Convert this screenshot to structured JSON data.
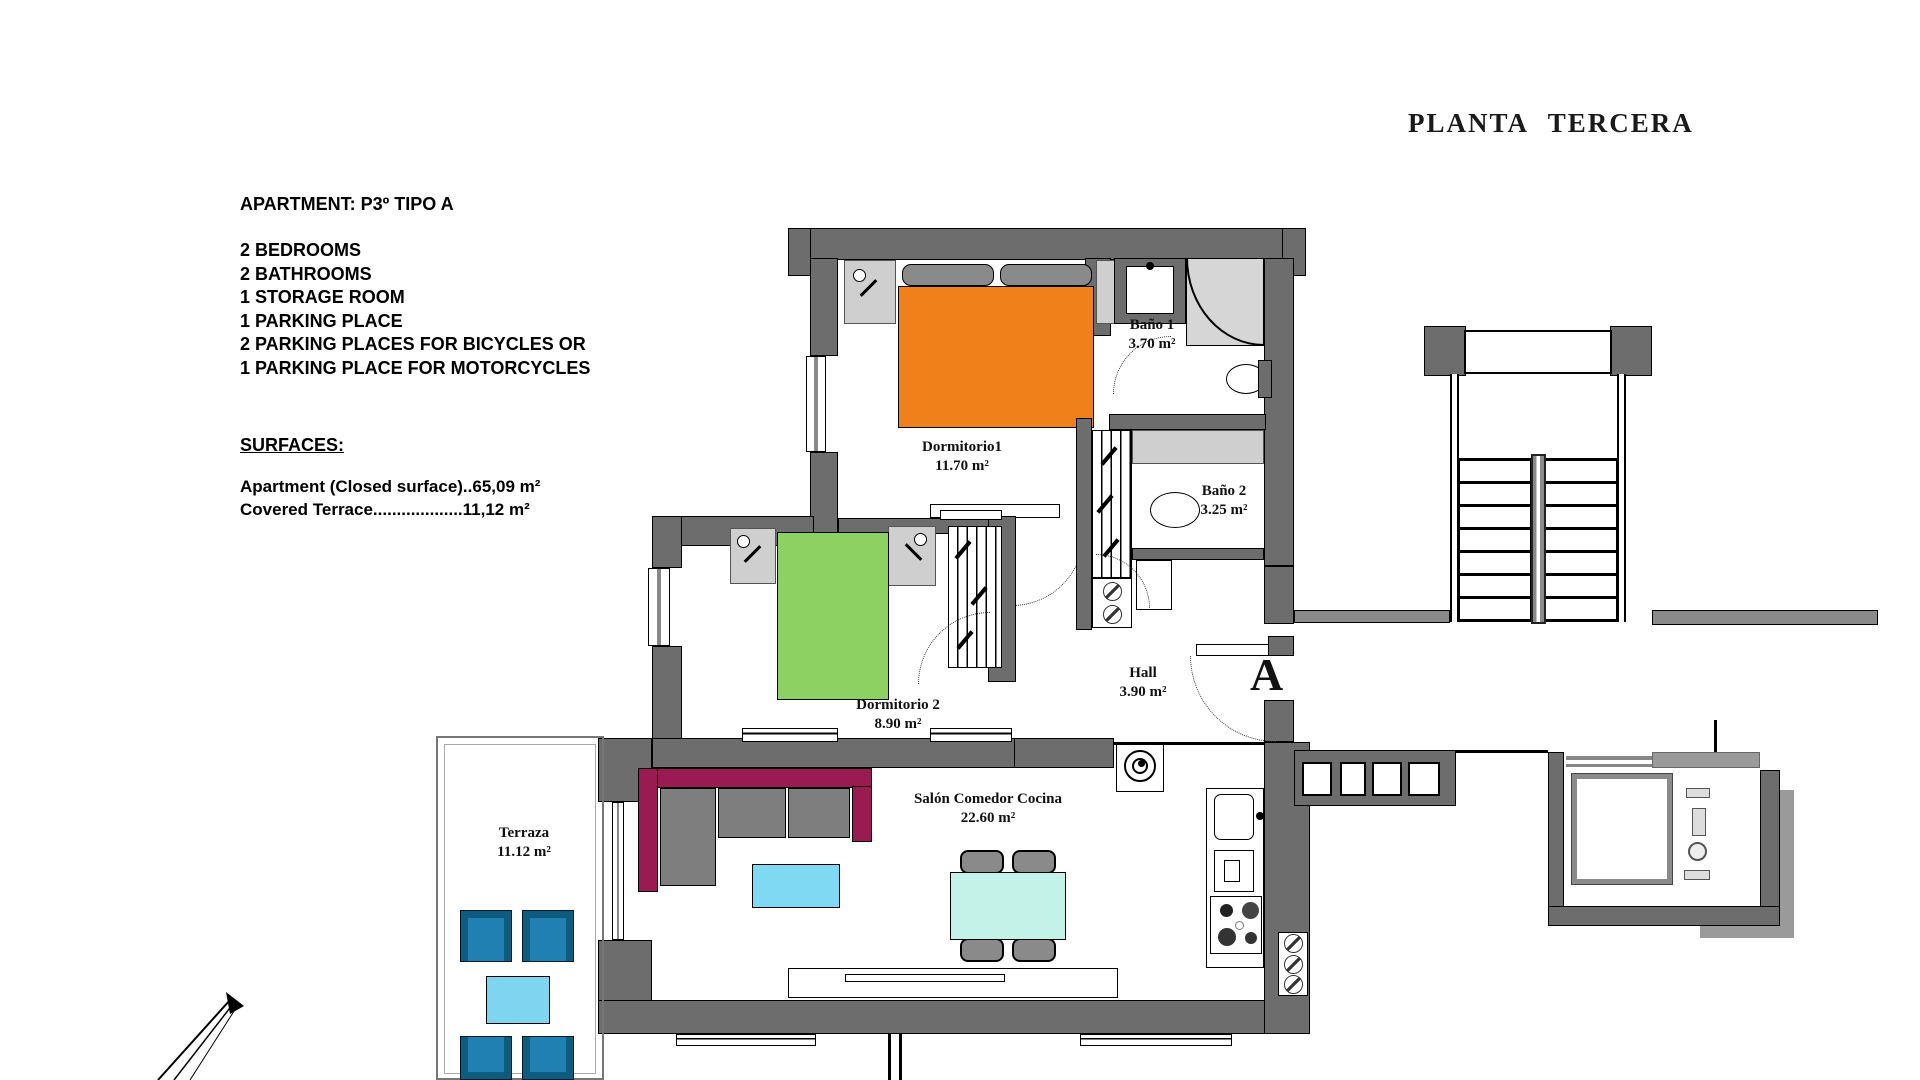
{
  "title": "PLANTA TERCERA",
  "info": {
    "apartment_label": "APARTMENT: P3º TIPO A",
    "features": [
      "2 BEDROOMS",
      "2 BATHROOMS",
      "1 STORAGE ROOM",
      "1 PARKING PLACE",
      "2 PARKING PLACES FOR BICYCLES OR",
      "1 PARKING PLACE FOR MOTORCYCLES"
    ],
    "surfaces_heading": "SURFACES:",
    "surfaces": [
      "Apartment (Closed surface)..65,09 m²",
      "Covered Terrace...................11,12 m²"
    ]
  },
  "rooms": [
    {
      "name": "Dormitorio1",
      "area": "11.70 m²"
    },
    {
      "name": "Baño 1",
      "area": "3.70 m²"
    },
    {
      "name": "Baño 2",
      "area": "3.25 m²"
    },
    {
      "name": "Dormitorio 2",
      "area": "8.90 m²"
    },
    {
      "name": "Hall",
      "area": "3.90 m²"
    },
    {
      "name": "Salón Comedor Cocina",
      "area": "22.60 m²"
    },
    {
      "name": "Terraza",
      "area": "11.12 m²"
    }
  ],
  "apartment_marker": "A",
  "colors": {
    "wall_gray": "#6d6d6d",
    "fixture_gray": "#cfcfcf",
    "bed1_orange": "#f08019",
    "bed2_green": "#8ed163",
    "sofa_magenta": "#9a1a52",
    "cushion_gray": "#7e7e7e",
    "coffee_table_cyan": "#7fd9f2",
    "dining_table_cyan": "#c3f2e9",
    "terrace_chair_blue": "#2180b2",
    "terrace_table_cyan": "#7fd4ef"
  }
}
